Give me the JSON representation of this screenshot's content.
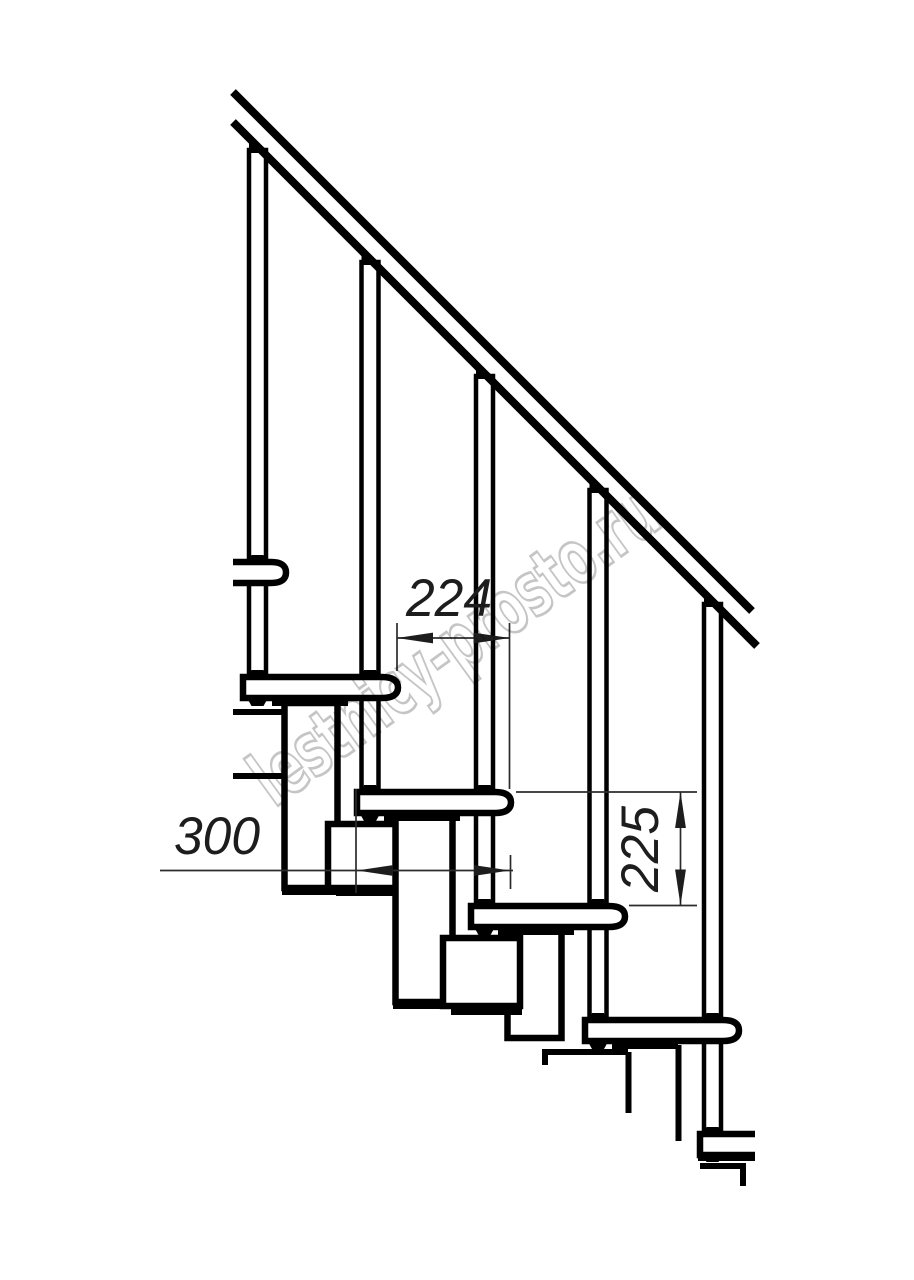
{
  "drawing": {
    "subject": "modular staircase side elevation technical drawing",
    "background_color": "#ffffff",
    "line_color": "#000000",
    "annotation_color": "#2b2b2b",
    "dimensions": {
      "going": {
        "value": "224",
        "orientation": "horizontal",
        "meaning": "horizontal offset between tread noses"
      },
      "tread_depth": {
        "value": "300",
        "orientation": "horizontal",
        "meaning": "tread depth"
      },
      "rise": {
        "value": "225",
        "orientation": "vertical",
        "meaning": "step rise between tread tops"
      }
    },
    "watermark": {
      "text": "lestnicy-prosto.ru",
      "color": "#c5c5c5",
      "angle_deg": -36
    },
    "components": {
      "treads_visible": 6,
      "balusters_visible": 5,
      "handrail_segments": 1
    }
  }
}
